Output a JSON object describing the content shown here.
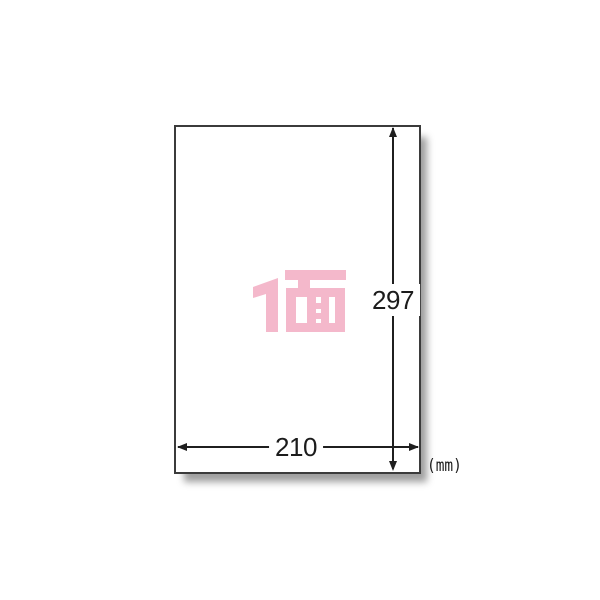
{
  "diagram": {
    "title": "label-sheet-dimension-diagram",
    "sheet": {
      "face_label": "1面",
      "faces_per_sheet": 1
    },
    "dimensions": {
      "height_mm": "297",
      "width_mm": "210",
      "unit": "(mm)"
    },
    "colors": {
      "face_label_pink": "#f4b8cb",
      "dimension_line": "#1f1f1f",
      "paper_border": "#3b3b3b",
      "background": "#ffffff"
    }
  }
}
